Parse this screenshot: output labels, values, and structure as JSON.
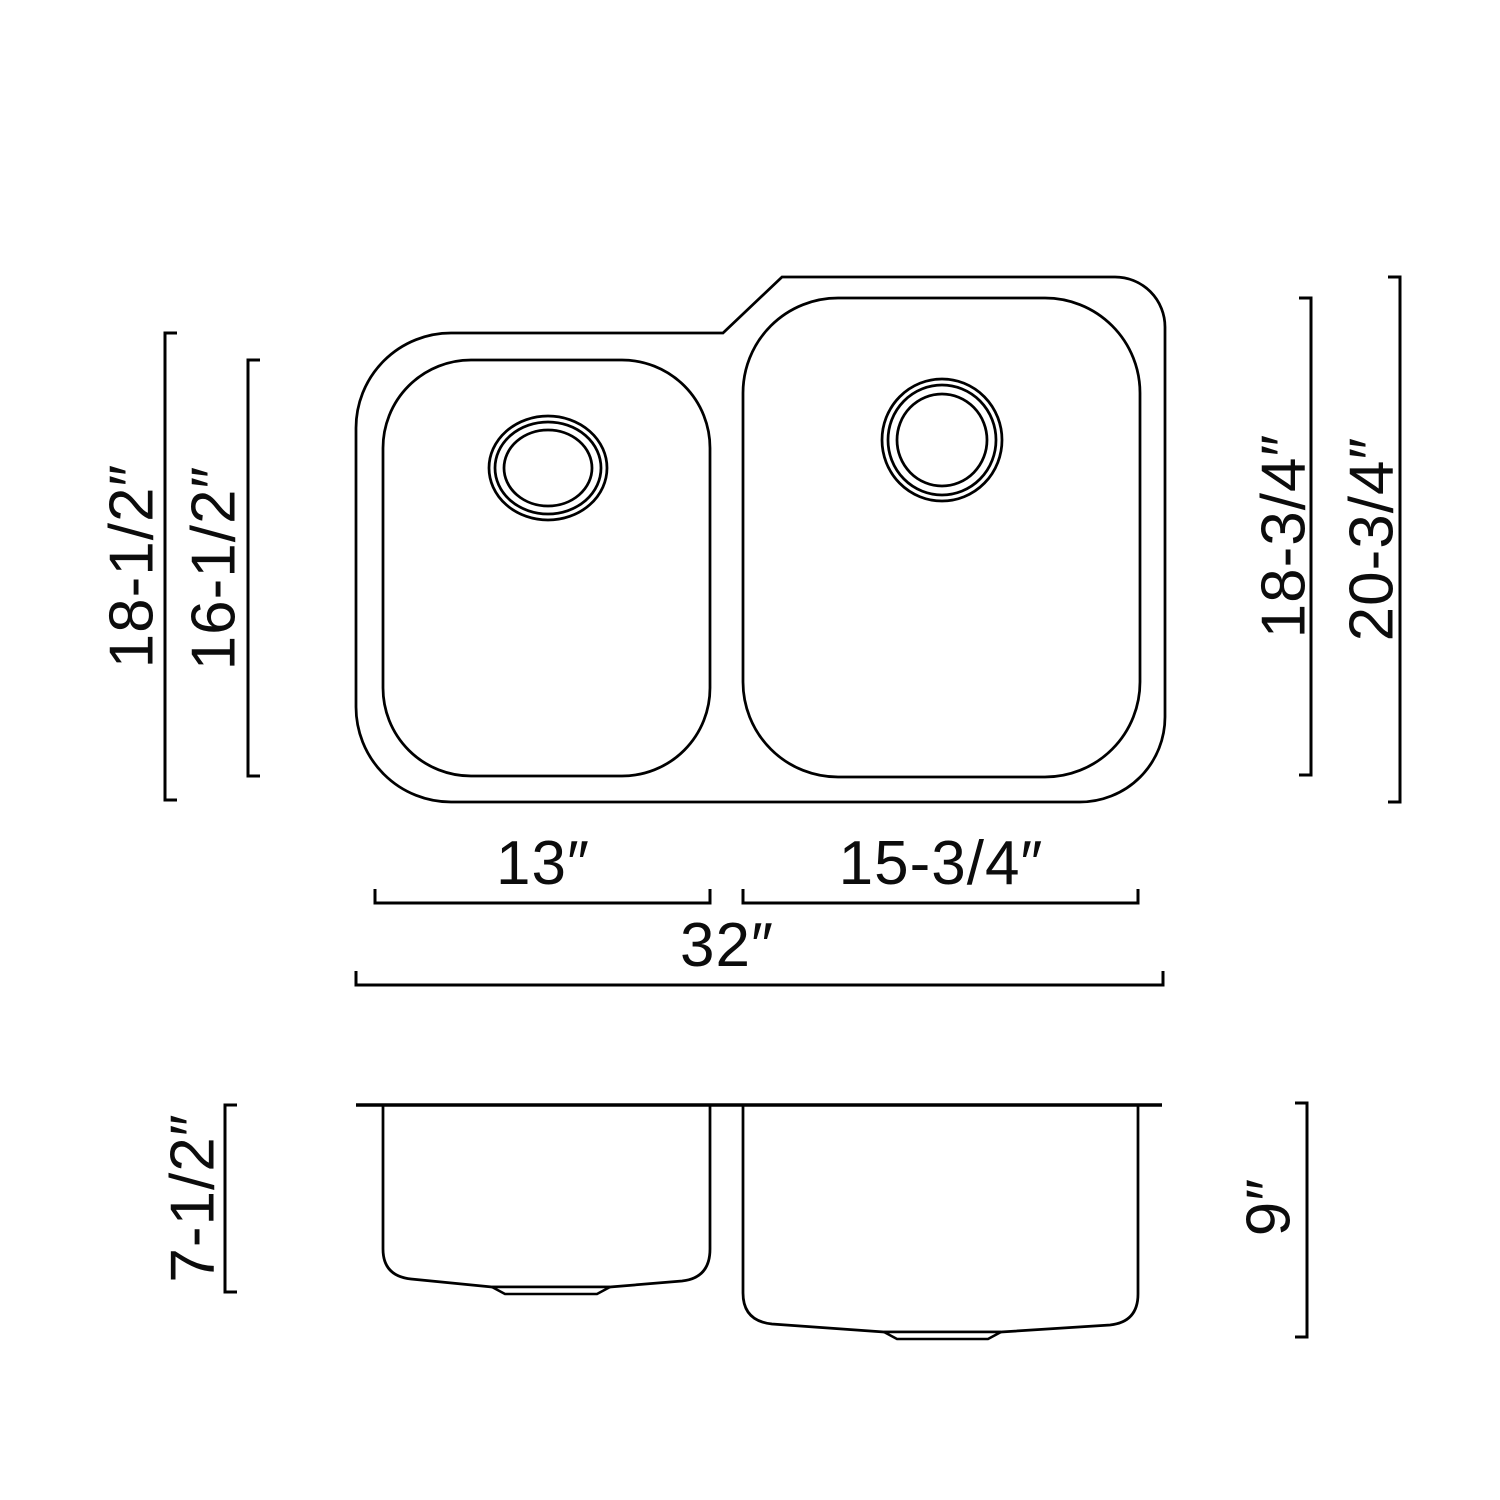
{
  "page": {
    "background_color": "#ffffff",
    "line_color": "#000000"
  },
  "top_view": {
    "labels": {
      "overall_height_left": "18-1/2″",
      "bowl_height_left": "16-1/2″",
      "bowl_height_right": "18-3/4″",
      "overall_height_right": "20-3/4″",
      "bowl_width_left": "13″",
      "bowl_width_right": "15-3/4″",
      "overall_width": "32″"
    }
  },
  "side_view": {
    "labels": {
      "depth_left": "7-1/2″",
      "depth_right": "9″"
    }
  }
}
